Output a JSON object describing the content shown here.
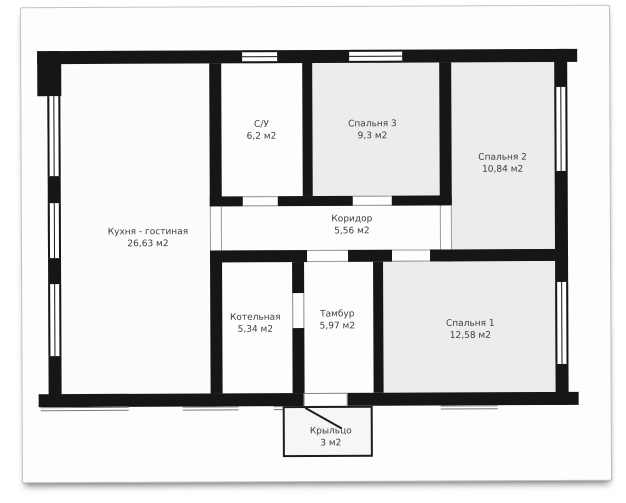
{
  "plan": {
    "title": "Floor plan of single-storey house",
    "area_unit": "м2",
    "rooms": [
      {
        "id": "kitchen-living",
        "name": "Кухня - гостиная",
        "area": "26,63 м2"
      },
      {
        "id": "bathroom",
        "name": "С/У",
        "area": "6,2 м2"
      },
      {
        "id": "bedroom-3",
        "name": "Спальня 3",
        "area": "9,3 м2"
      },
      {
        "id": "bedroom-2",
        "name": "Спальня 2",
        "area": "10,84 м2"
      },
      {
        "id": "corridor",
        "name": "Коридор",
        "area": "5,56 м2"
      },
      {
        "id": "boiler-room",
        "name": "Котельная",
        "area": "5,34 м2"
      },
      {
        "id": "vestibule",
        "name": "Тамбур",
        "area": "5,97 м2"
      },
      {
        "id": "bedroom-1",
        "name": "Спальня 1",
        "area": "12,58 м2"
      },
      {
        "id": "porch",
        "name": "Крыльцо",
        "area": "3 м2"
      }
    ],
    "colors": {
      "wall": "#161616",
      "bedroom_fill": "#ececec",
      "room_fill": "#fdfdfd",
      "porch_fill": "#f6f6f4",
      "page_background": "#fdfdfd"
    }
  }
}
